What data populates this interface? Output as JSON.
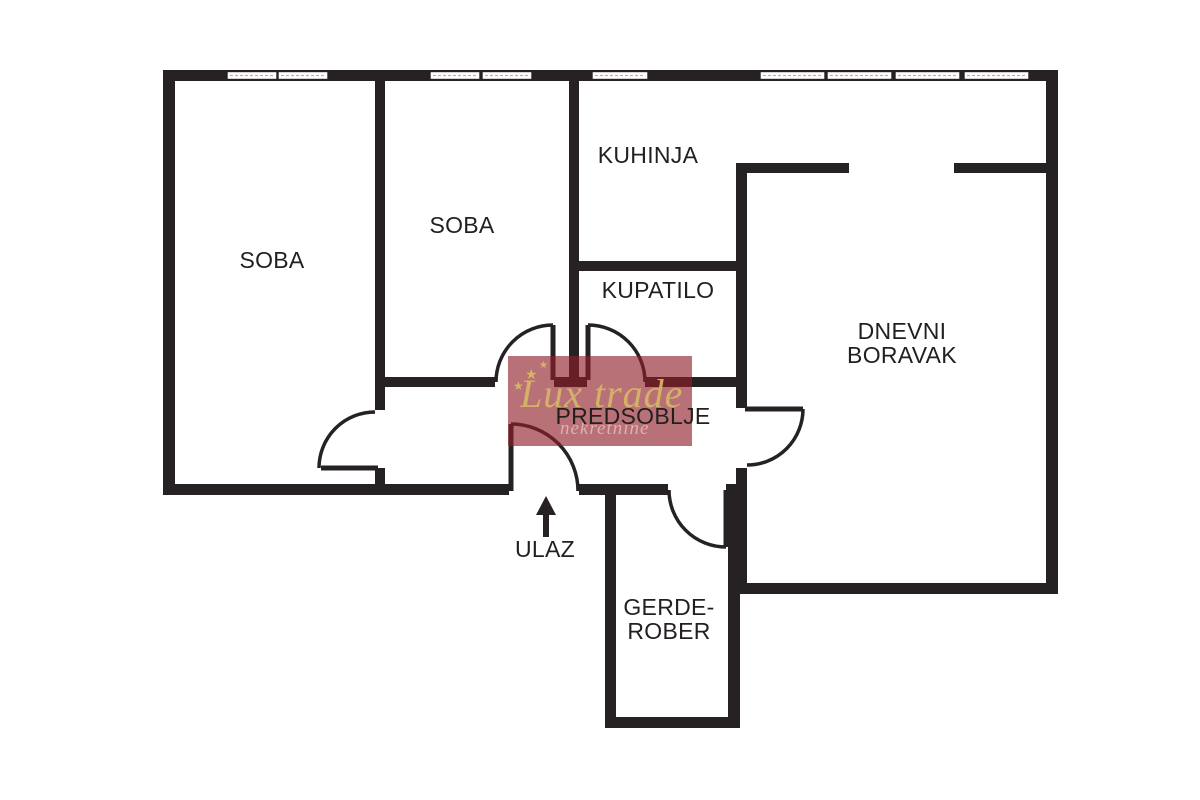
{
  "colors": {
    "wall_color": "#262122",
    "label_color": "#231f20",
    "wm_bg": "rgba(143,30,40,0.63)",
    "wm_gold": "#d8b566",
    "wm_sub": "rgba(233,193,186,0.78)"
  },
  "rooms": {
    "soba1": "SOBA",
    "soba2": "SOBA",
    "kuhinja": "KUHINJA",
    "kupatilo": "KUPATILO",
    "dnevni_line1": "DNEVNI",
    "dnevni_line2": "BORAVAK",
    "predsoblje": "PREDSOBLJE",
    "gerderober_line1": "GERDE-",
    "gerderober_line2": "ROBER"
  },
  "entrance": {
    "label": "ULAZ"
  },
  "watermark": {
    "brand": "Lux trade",
    "subtitle": "nekretnine",
    "star_glyph": "★"
  }
}
